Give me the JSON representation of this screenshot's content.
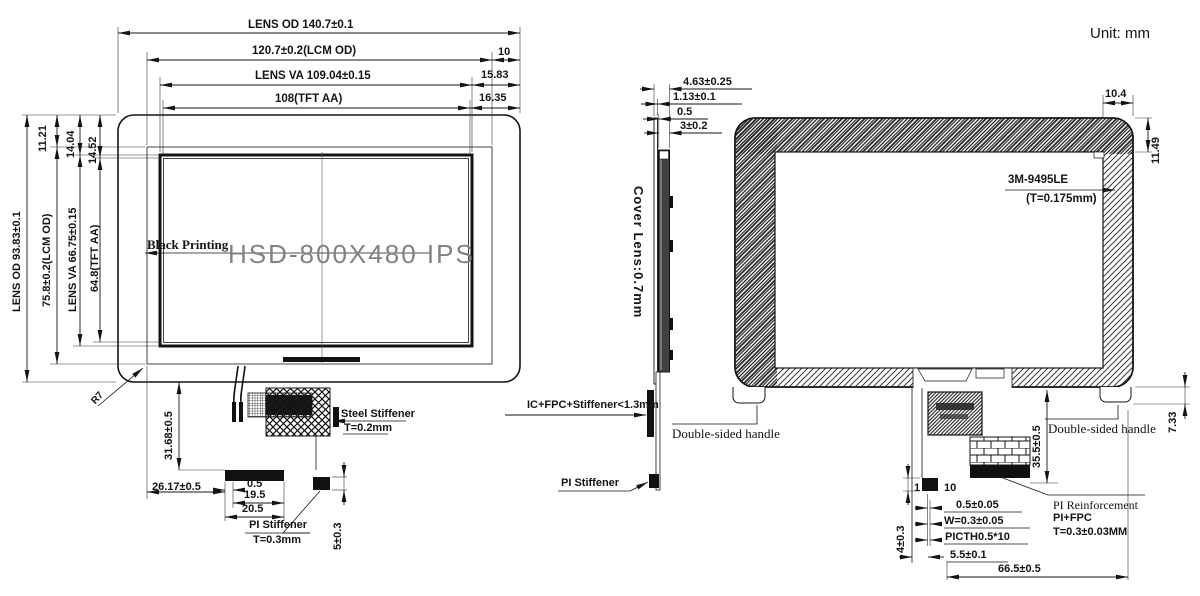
{
  "unit_label": "Unit: mm",
  "front": {
    "top_od": "LENS OD 140.7±0.1",
    "top_lcm": "120.7±0.2(LCM OD)",
    "top_va": "LENS VA 109.04±0.15",
    "top_aa": "108(TFT AA)",
    "right_10": "10",
    "right_1583": "15.83",
    "right_1635": "16.35",
    "left_od": "LENS OD 93.83±0.1",
    "left_lcm": "75.8±0.2(LCM OD)",
    "left_va": "LENS VA 66.75±0.15",
    "left_aa": "64.8(TFT AA)",
    "left_1121": "11.21",
    "left_1404": "14.04",
    "left_1452": "14.52",
    "black_printing": "Black Printing",
    "watermark": "HSD-800X480 IPS",
    "corner_radius": "R7",
    "fpc_3168": "31.68±0.5",
    "fpc_2617": "26.17±0.5",
    "fpc_05": "0.5",
    "fpc_195": "19.5",
    "fpc_205": "20.5",
    "steel_stiffener": "Steel Stiffener",
    "steel_t": "T=0.2mm",
    "pi_stiffener": "PI Stiffener",
    "pi_t": "T=0.3mm",
    "fpc_5": "5±0.3"
  },
  "side": {
    "cover_lens": "Cover Lens:0.7mm",
    "d1": "4.63±0.25",
    "d2": "1.13±0.1",
    "d3": "0.5",
    "d4": "3±0.2",
    "ic": "IC+FPC+Stiffener<1.3mm",
    "pi": "PI Stiffener"
  },
  "back": {
    "top_104": "10.4",
    "corner_1149": "11.49",
    "tape": "3M-9495LE",
    "tape_t": "(T=0.175mm)",
    "handle_left": "Double-sided handle",
    "handle_right": "Double-sided handle",
    "tab_733": "7.33",
    "fpc_355": "35.5±0.5",
    "pir1": "PI Reinforcement",
    "pir2": "PI+FPC",
    "pir3": "T=0.3±0.03MM",
    "b_05": "0.5±0.05",
    "b_w": "W=0.3±0.05",
    "b_picth": "PICTH0.5*10",
    "b_55": "5.5±0.1",
    "b_665": "66.5±0.5",
    "d_1": "1",
    "d_10": "10",
    "d_4": "4±0.3"
  }
}
